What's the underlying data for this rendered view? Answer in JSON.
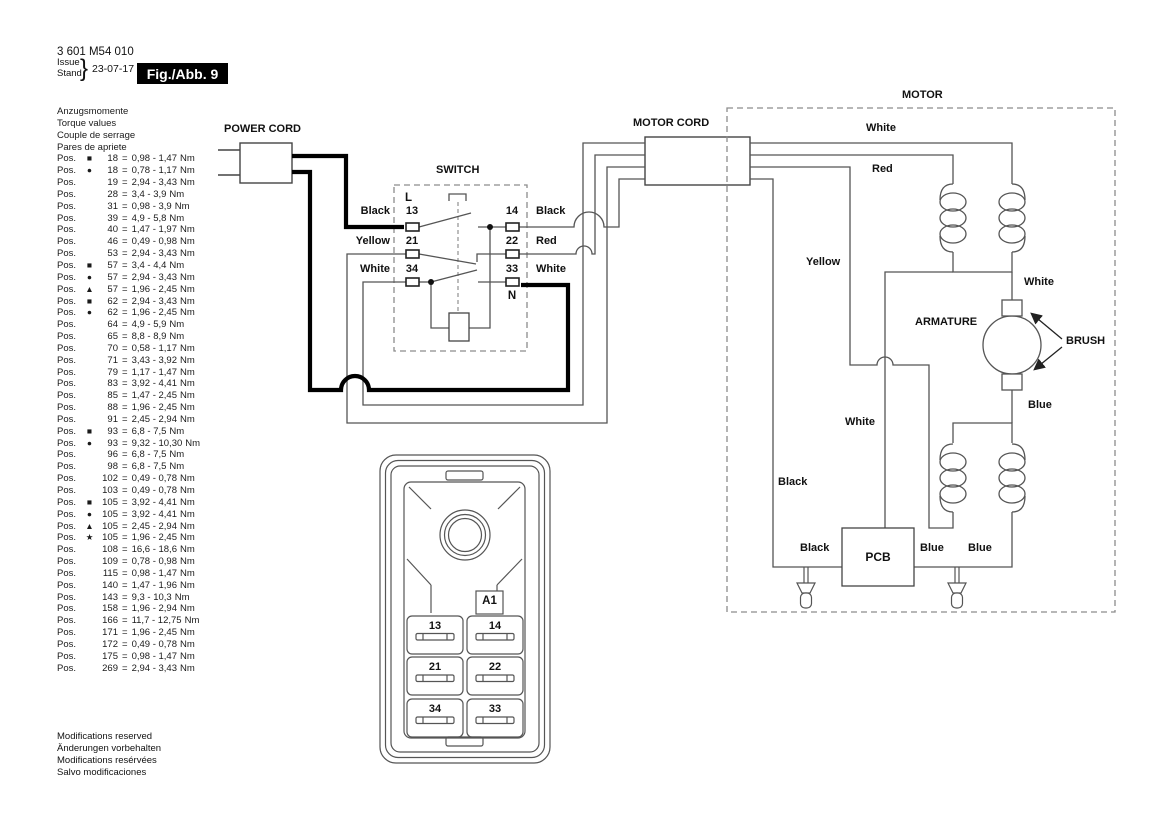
{
  "header": {
    "part_number": "3 601 M54 010",
    "issue_label": "Issue",
    "stand_label": "Stand",
    "brace": "}",
    "date": "23-07-17",
    "fig_label": "Fig./Abb. 9"
  },
  "torque": {
    "headings": [
      "Anzugsmomente",
      "Torque values",
      "Couple de serrage",
      "Pares de apriete"
    ],
    "pos_label": "Pos.",
    "eq": "=",
    "unit": "Nm",
    "items": [
      {
        "s": "■",
        "n": "18",
        "r": "0,98 - 1,47"
      },
      {
        "s": "●",
        "n": "18",
        "r": "0,78 - 1,17"
      },
      {
        "s": "",
        "n": "19",
        "r": "2,94 - 3,43"
      },
      {
        "s": "",
        "n": "28",
        "r": "3,4 - 3,9"
      },
      {
        "s": "",
        "n": "31",
        "r": "0,98 - 3,9"
      },
      {
        "s": "",
        "n": "39",
        "r": "4,9 - 5,8"
      },
      {
        "s": "",
        "n": "40",
        "r": "1,47 - 1,97"
      },
      {
        "s": "",
        "n": "46",
        "r": "0,49 - 0,98"
      },
      {
        "s": "",
        "n": "53",
        "r": "2,94 - 3,43"
      },
      {
        "s": "■",
        "n": "57",
        "r": "3,4 - 4,4"
      },
      {
        "s": "●",
        "n": "57",
        "r": "2,94 - 3,43"
      },
      {
        "s": "▲",
        "n": "57",
        "r": "1,96 - 2,45"
      },
      {
        "s": "■",
        "n": "62",
        "r": "2,94 - 3,43"
      },
      {
        "s": "●",
        "n": "62",
        "r": "1,96 - 2,45"
      },
      {
        "s": "",
        "n": "64",
        "r": "4,9 - 5,9"
      },
      {
        "s": "",
        "n": "65",
        "r": "8,8 - 8,9"
      },
      {
        "s": "",
        "n": "70",
        "r": "0,58 - 1,17"
      },
      {
        "s": "",
        "n": "71",
        "r": "3,43 - 3,92"
      },
      {
        "s": "",
        "n": "79",
        "r": "1,17 - 1,47"
      },
      {
        "s": "",
        "n": "83",
        "r": "3,92 - 4,41"
      },
      {
        "s": "",
        "n": "85",
        "r": "1,47 - 2,45"
      },
      {
        "s": "",
        "n": "88",
        "r": "1,96 - 2,45"
      },
      {
        "s": "",
        "n": "91",
        "r": "2,45 - 2,94"
      },
      {
        "s": "■",
        "n": "93",
        "r": "6,8 - 7,5"
      },
      {
        "s": "●",
        "n": "93",
        "r": "9,32 - 10,30"
      },
      {
        "s": "",
        "n": "96",
        "r": "6,8 - 7,5"
      },
      {
        "s": "",
        "n": "98",
        "r": "6,8 - 7,5"
      },
      {
        "s": "",
        "n": "102",
        "r": "0,49 - 0,78"
      },
      {
        "s": "",
        "n": "103",
        "r": "0,49 - 0,78"
      },
      {
        "s": "■",
        "n": "105",
        "r": "3,92 - 4,41"
      },
      {
        "s": "●",
        "n": "105",
        "r": "3,92 - 4,41"
      },
      {
        "s": "▲",
        "n": "105",
        "r": "2,45 - 2,94"
      },
      {
        "s": "★",
        "n": "105",
        "r": "1,96 - 2,45"
      },
      {
        "s": "",
        "n": "108",
        "r": "16,6 - 18,6"
      },
      {
        "s": "",
        "n": "109",
        "r": "0,78 - 0,98"
      },
      {
        "s": "",
        "n": "115",
        "r": "0,98 - 1,47"
      },
      {
        "s": "",
        "n": "140",
        "r": "1,47 - 1,96"
      },
      {
        "s": "",
        "n": "143",
        "r": "9,3 - 10,3"
      },
      {
        "s": "",
        "n": "158",
        "r": "1,96 - 2,94"
      },
      {
        "s": "",
        "n": "166",
        "r": "11,7 - 12,75"
      },
      {
        "s": "",
        "n": "171",
        "r": "1,96 - 2,45"
      },
      {
        "s": "",
        "n": "172",
        "r": "0,49 - 0,78"
      },
      {
        "s": "",
        "n": "175",
        "r": "0,98 - 1,47"
      },
      {
        "s": "",
        "n": "269",
        "r": "2,94 - 3,43"
      }
    ]
  },
  "footer": {
    "lines": [
      "Modifications reserved",
      "Änderungen vorbehalten",
      "Modifications resérvées",
      "Salvo modificaciones"
    ]
  },
  "diagram": {
    "power_cord_label": "POWER CORD",
    "switch_label": "SWITCH",
    "motor_cord_label": "MOTOR CORD",
    "motor_label": "MOTOR",
    "armature_label": "ARMATURE",
    "brush_label": "BRUSH",
    "pcb_label": "PCB",
    "l_label": "L",
    "n_label": "N",
    "terminals": {
      "t13": "13",
      "t14": "14",
      "t21": "21",
      "t22": "22",
      "t34": "34",
      "t33": "33"
    },
    "wire_labels": {
      "sw_left_13": "Black",
      "sw_left_21": "Yellow",
      "sw_left_34": "White",
      "sw_right_14": "Black",
      "sw_right_22": "Red",
      "sw_right_33": "White",
      "motor_top_white": "White",
      "motor_top_red": "Red",
      "motor_yellow": "Yellow",
      "armature_top_white": "White",
      "armature_blue": "Blue",
      "pcb_white": "White",
      "motor_black": "Black",
      "pcb_black": "Black",
      "pcb_blue_1": "Blue",
      "pcb_blue_2": "Blue"
    }
  },
  "switch_module": {
    "a1": "A1",
    "terminals": {
      "t13": "13",
      "t14": "14",
      "t21": "21",
      "t22": "22",
      "t34": "34",
      "t33": "33"
    }
  },
  "colors": {
    "line_thin": "#555555",
    "line_thick": "#000000",
    "box": "#444444",
    "dashed": "#8c8c8c",
    "text": "#111111"
  }
}
